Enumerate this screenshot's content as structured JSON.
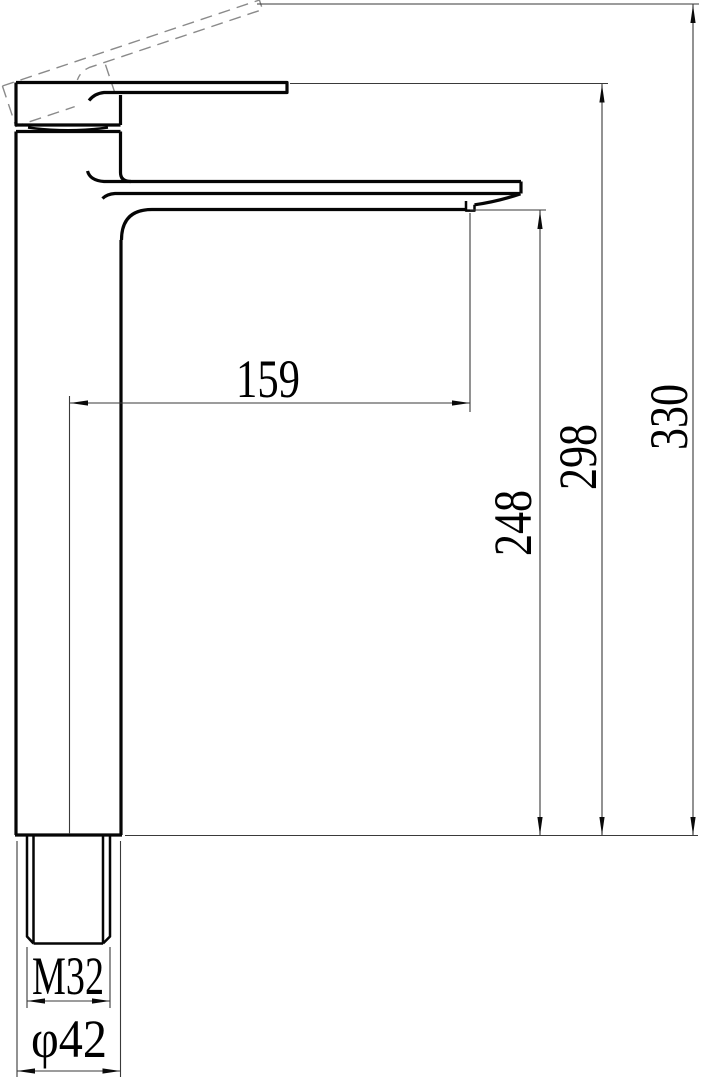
{
  "drawing": {
    "background_color": "#ffffff",
    "outline_color": "#050505",
    "dimension_line_color": "#3a3a3a",
    "hidden_line_color": "#8a8a8a",
    "dimensions": {
      "spout_reach": "159",
      "spout_outlet_height": "248",
      "body_top_height": "298",
      "overall_height": "330",
      "mounting_thread": "M32",
      "base_diameter": "φ42"
    }
  }
}
